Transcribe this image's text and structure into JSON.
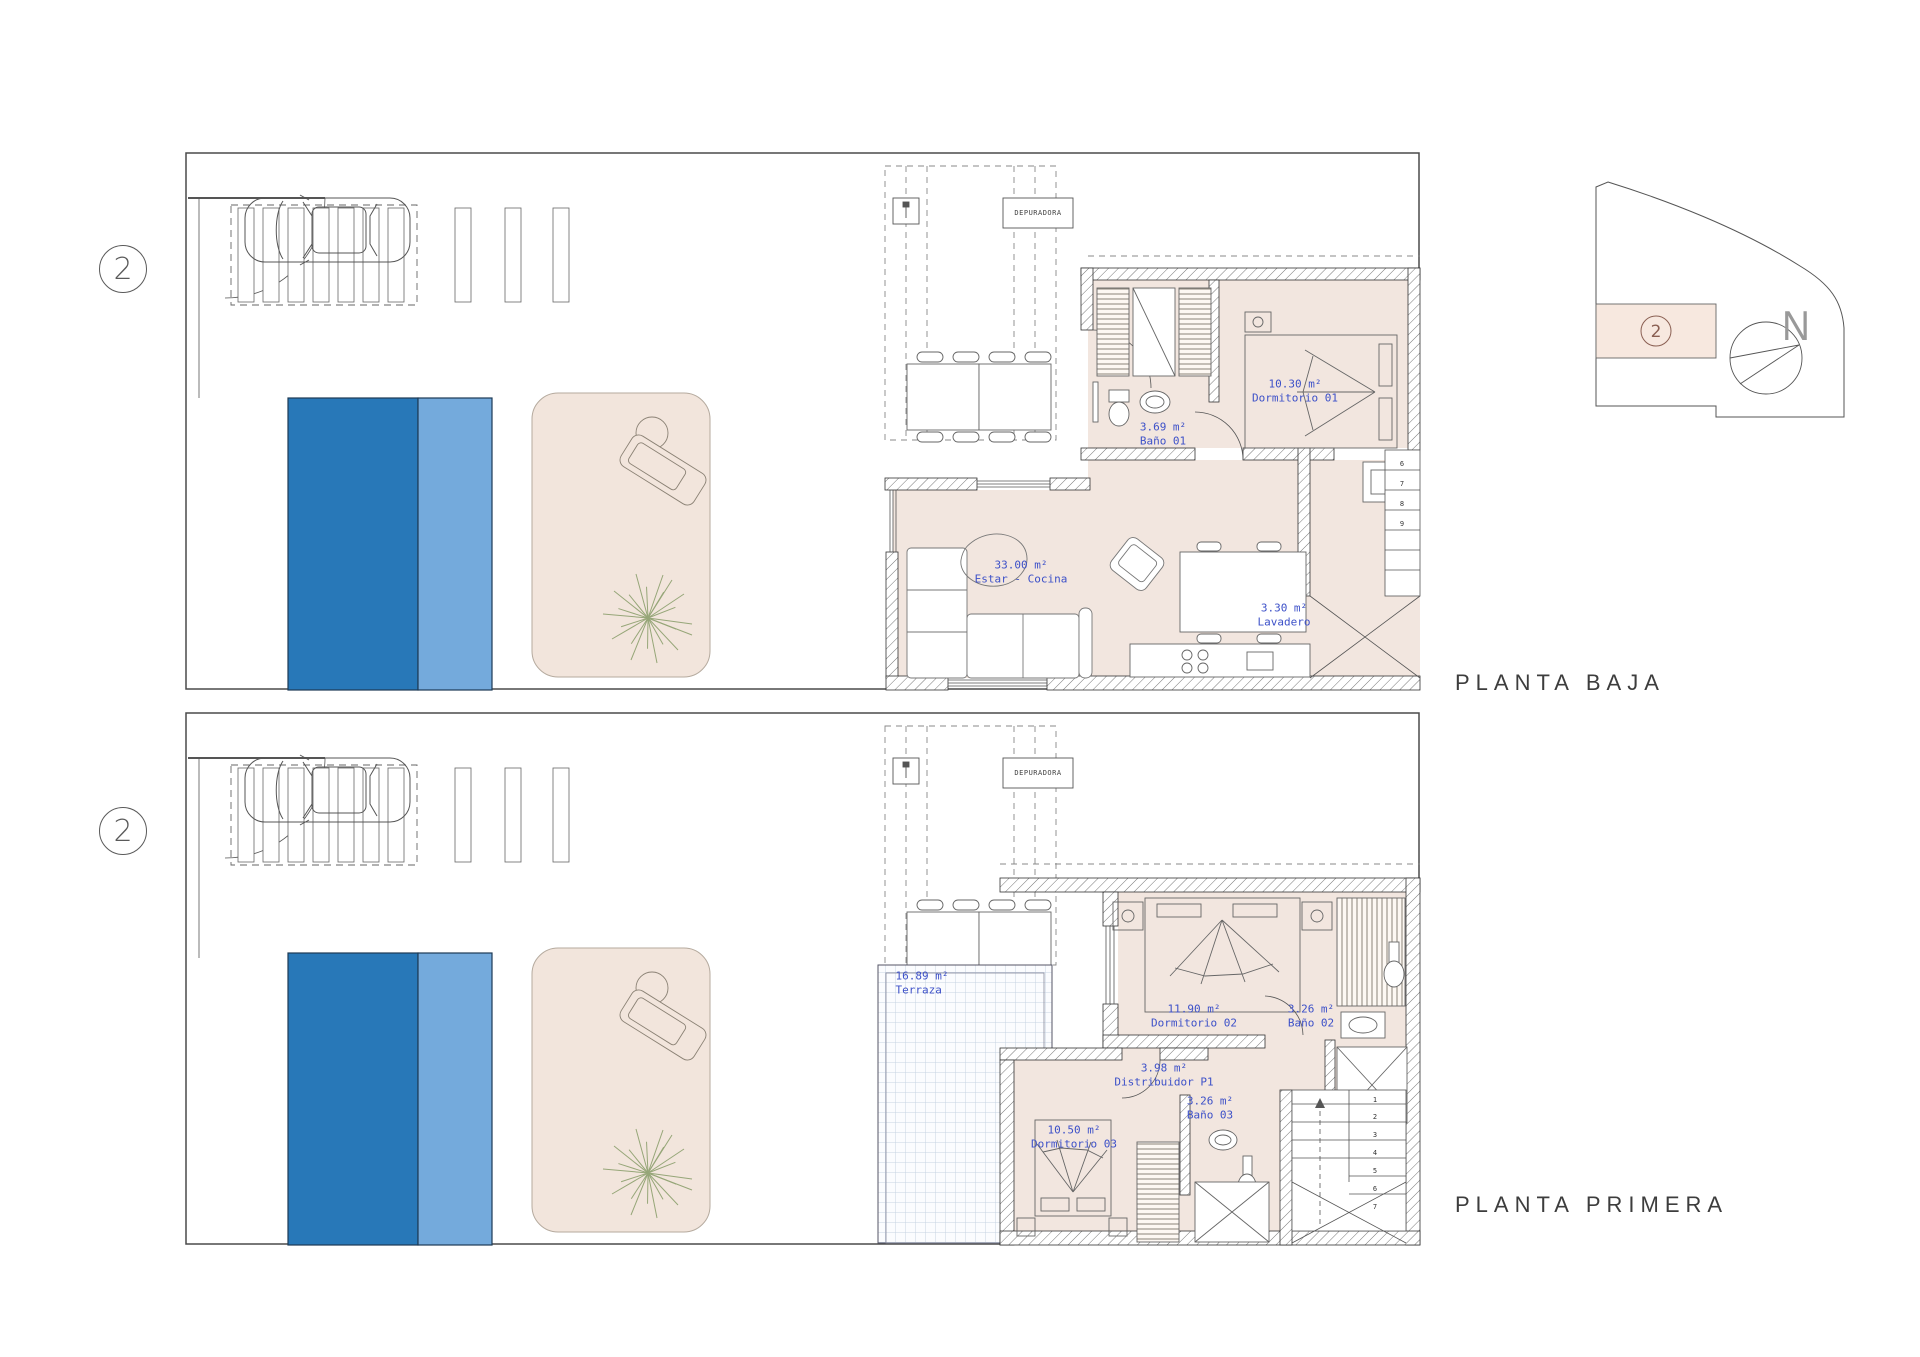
{
  "plans": [
    {
      "title": "PLANTA BAJA",
      "unit_badge": "2",
      "equipment_label": "DEPURADORA",
      "rooms": [
        {
          "area": "3.69 m²",
          "name": "Baño 01"
        },
        {
          "area": "10.30 m²",
          "name": "Dormitorio 01"
        },
        {
          "area": "33.00 m²",
          "name": "Estar - Cocina"
        },
        {
          "area": "3.30 m²",
          "name": "Lavadero"
        }
      ],
      "stair_treads": [
        "6",
        "7",
        "8",
        "9"
      ]
    },
    {
      "title": "PLANTA PRIMERA",
      "unit_badge": "2",
      "equipment_label": "DEPURADORA",
      "rooms": [
        {
          "area": "16.89 m²",
          "name": "Terraza"
        },
        {
          "area": "11.90 m²",
          "name": "Dormitorio 02"
        },
        {
          "area": "3.26 m²",
          "name": "Baño 02"
        },
        {
          "area": "3.98 m²",
          "name": "Distribuidor P1"
        },
        {
          "area": "10.50 m²",
          "name": "Dormitorio 03"
        },
        {
          "area": "3.26 m²",
          "name": "Baño 03"
        }
      ],
      "stair_treads": [
        "1",
        "2",
        "3",
        "4",
        "5",
        "6",
        "7"
      ]
    }
  ],
  "site_key": {
    "unit_badge": "2",
    "north_label": "N"
  },
  "colors": {
    "pool_deep": "#2878b8",
    "pool_shallow": "#74aadc",
    "patio_fill": "#f2e5dc",
    "floor_fill": "#f2e6df",
    "label_blue": "#3c50c8",
    "key_highlight": "#f7e8df"
  }
}
